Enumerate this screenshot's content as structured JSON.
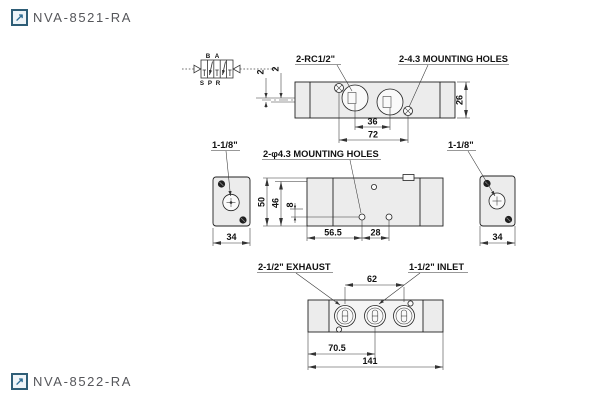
{
  "products": {
    "top": {
      "label": "NVA-8521-RA"
    },
    "bottom": {
      "label": "NVA-8522-RA"
    }
  },
  "icons": {
    "link_arrow": "↗"
  },
  "colors": {
    "accent_blue": "#2e6d94",
    "body_gray": "#ececec",
    "line": "#222222",
    "label_gray": "#55565a"
  },
  "drawing": {
    "symbol": {
      "b": "B",
      "a": "A",
      "s": "S",
      "p": "P",
      "r": "R"
    },
    "top_view": {
      "port_label": "2-RC1/2\"",
      "mount_label": "2-4.3 MOUNTING HOLES",
      "dim_pitch": "36",
      "dim_span": "72",
      "dim_height": "26",
      "dim_offset_a": "2",
      "dim_offset_b": "2"
    },
    "left_view": {
      "port_label": "1-1/8\"",
      "dim_width": "34"
    },
    "front_view": {
      "mount_label": "2-φ4.3 MOUNTING HOLES",
      "dim_height": "50",
      "dim_mid": "46",
      "dim_hole": "8",
      "dim_w1": "56.5",
      "dim_w2": "28"
    },
    "right_view": {
      "port_label": "1-1/8\"",
      "dim_width": "34"
    },
    "bottom_view": {
      "exhaust_label": "2-1/2\" EXHAUST",
      "inlet_label": "1-1/2\" INLET",
      "dim_pitch": "62",
      "dim_w1": "70.5",
      "dim_w2": "141"
    }
  }
}
